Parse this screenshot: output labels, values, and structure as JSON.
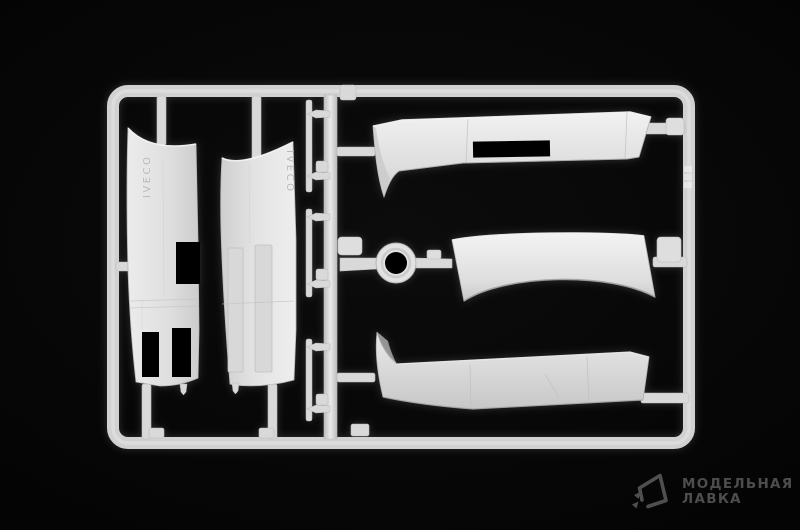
{
  "scene": {
    "background_color": "#000000",
    "plastic_color": "#dcdcdc",
    "plastic_highlight": "#f5f5f5",
    "plastic_shadow": "#a8a8a8"
  },
  "sprue": {
    "left_fairing_text": "IVECO",
    "right_fairing_text": "IVECO",
    "parts": [
      {
        "name": "side-fairing-left"
      },
      {
        "name": "side-fairing-right"
      },
      {
        "name": "wind-deflector-upper"
      },
      {
        "name": "roof-panel-center"
      },
      {
        "name": "wind-deflector-lower"
      },
      {
        "name": "ring-grommet"
      },
      {
        "name": "small-pin-parts"
      }
    ]
  },
  "watermark": {
    "line1": "МОДЕЛЬНАЯ",
    "line2": "ЛАВКА",
    "color": "#4d4d4d",
    "logo": "paper-plane-icon"
  }
}
